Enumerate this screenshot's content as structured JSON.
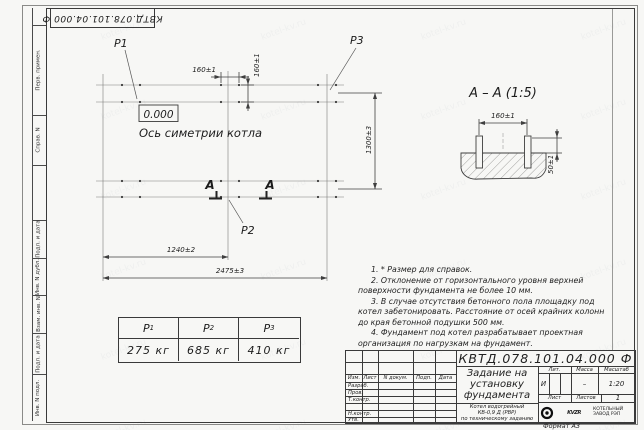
{
  "meta": {
    "doc_number": "КВТД.078.101.04.000 Ф",
    "format_label": "Формат А3"
  },
  "frame": {
    "left_fields": [
      "Перв. примен.",
      "Справ. N",
      "Подп. и дата",
      "Инв. N дубл.",
      "Взам. инв. N",
      "Подп. и дата",
      "Инв. N подл."
    ]
  },
  "plan": {
    "p1": "P1",
    "p2": "P2",
    "p3": "P3",
    "level_mark": "0.000",
    "axis_label": "Ось симетрии котла",
    "section_letter": "А",
    "dims": {
      "h160": "160±1",
      "v160": "160±1",
      "v1300": "1300±3",
      "b1240": "1240±2",
      "b2475": "2475±3"
    }
  },
  "section": {
    "title": "А – А (1:5)",
    "dims": {
      "top160": "160±1",
      "h50": "50±1"
    }
  },
  "notes": [
    "1. * Размер для справок.",
    "2. Отклонение от горизонтального уровня верхней поверхности фундамента не более 10 мм.",
    "3. В случае отсутствия бетонного пола площадку под котел забетонировать. Расстояние от осей крайних колонн до края бетонной подушки 500 мм.",
    "4. Фундамент под котел разрабатывает проектная организация по нагрузкам на фундамент."
  ],
  "load_table": {
    "headers": [
      {
        "base": "P",
        "sub": "1"
      },
      {
        "base": "P",
        "sub": "2"
      },
      {
        "base": "P",
        "sub": "3"
      }
    ],
    "values": [
      "275 кг",
      "685 кг",
      "410 кг"
    ]
  },
  "title_block": {
    "doc_number": "КВТД.078.101.04.000 Ф",
    "columns": {
      "izm": "Изм.",
      "list": "Лист",
      "doc": "N докум.",
      "podp": "Подп.",
      "date": "Дата"
    },
    "rows": [
      "Разраб.",
      "Пров.",
      "Т.контр.",
      "",
      "Н.контр.",
      "Утв."
    ],
    "title_lines": [
      "Задание на",
      "установку",
      "фундамента"
    ],
    "product_lines": [
      "Котел водогрейный",
      "КВ-0,9 Д (РВР)",
      "по техническому заданию"
    ],
    "lit_label": "Лит.",
    "lit_value": "И",
    "mass_label": "Масса",
    "mass_value": "–",
    "scale_label": "Масштаб",
    "scale_value": "1:20",
    "sheet_label": "Лист",
    "sheets_label": "Листов",
    "sheets_value": "1",
    "company": {
      "logo_text": "KVZR",
      "name_lines": [
        "КОТЕЛЬНЫЙ",
        "ЗАВОД РЭП"
      ]
    }
  },
  "watermark": "kotel-kv.ru",
  "colors": {
    "line": "#3a3a3a",
    "paper": "#f7f7f5",
    "ink": "#1c1c1c"
  }
}
